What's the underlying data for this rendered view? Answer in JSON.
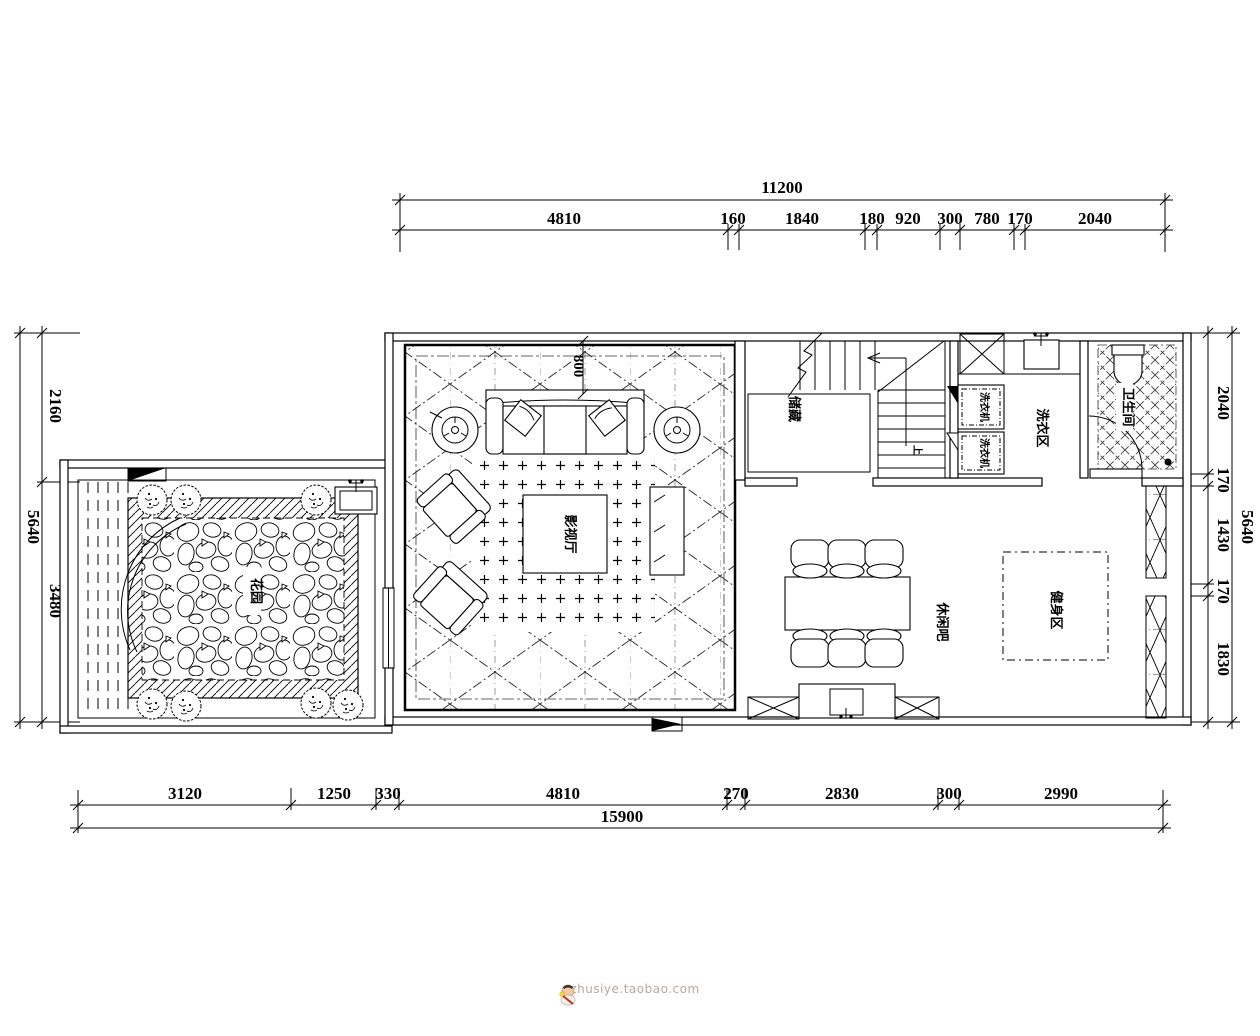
{
  "dimensions": {
    "top": {
      "total": "11200",
      "segments": [
        "4810",
        "160",
        "1840",
        "180",
        "920",
        "300",
        "780",
        "170",
        "2040"
      ]
    },
    "bottom": {
      "total": "15900",
      "segments": [
        "3120",
        "1250",
        "330",
        "4810",
        "270",
        "2830",
        "300",
        "2990"
      ]
    },
    "left": {
      "total": "5640",
      "segments": [
        "2160",
        "3480"
      ]
    },
    "right": {
      "total": "5640",
      "segments": [
        "2040",
        "170",
        "1430",
        "170",
        "1830"
      ]
    }
  },
  "rooms": {
    "garden": "花园",
    "media_room": "影视厅",
    "storage": "储藏",
    "washing_machine": "洗衣机",
    "laundry_area": "洗衣区",
    "bathroom": "卫生间",
    "leisure_bar": "休闲吧",
    "fitness_area": "健身区"
  },
  "annotations": {
    "sofa_clearance": "800",
    "stairs_up": "上"
  },
  "watermark": {
    "site": "zhusiye.taobao.com"
  },
  "colors": {
    "line": "#000000",
    "background": "#ffffff",
    "watermark_text": "#b3aba4"
  }
}
